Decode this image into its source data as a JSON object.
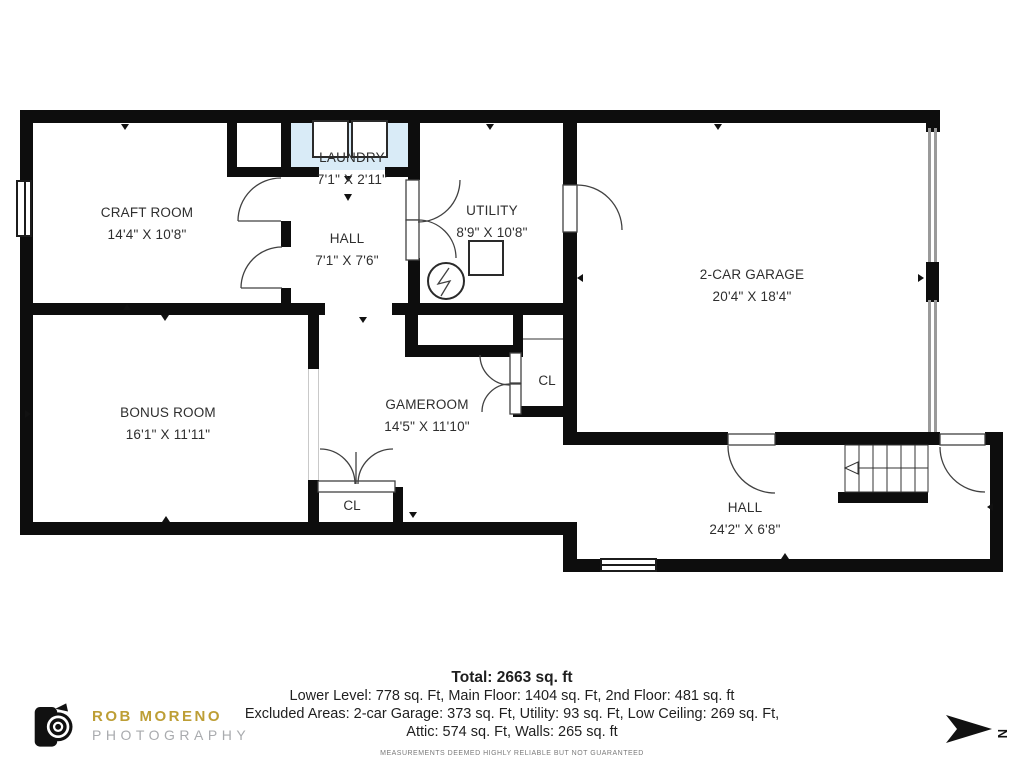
{
  "plan": {
    "rooms": {
      "craft_room": {
        "name": "CRAFT ROOM",
        "dims": "14'4\" X 10'8\""
      },
      "laundry": {
        "name": "LAUNDRY",
        "dims": "7'1\" X 2'11\""
      },
      "hall_upper": {
        "name": "HALL",
        "dims": "7'1\" X 7'6\""
      },
      "utility": {
        "name": "UTILITY",
        "dims": "8'9\" X 10'8\""
      },
      "garage": {
        "name": "2-CAR GARAGE",
        "dims": "20'4\" X 18'4\""
      },
      "bonus_room": {
        "name": "BONUS ROOM",
        "dims": "16'1\" X 11'11\""
      },
      "gameroom": {
        "name": "GAMEROOM",
        "dims": "14'5\" X 11'10\""
      },
      "hall_lower": {
        "name": "HALL",
        "dims": "24'2\" X 6'8\""
      }
    },
    "closets": {
      "gameroom_closet": "CL",
      "bonus_hall_closet": "CL"
    }
  },
  "summary": {
    "total": "Total: 2663 sq. ft",
    "line1": "Lower Level: 778 sq. Ft, Main Floor: 1404 sq. Ft, 2nd Floor: 481 sq. ft",
    "line2": "Excluded Areas: 2-car Garage: 373 sq. Ft, Utility: 93 sq. Ft, Low Ceiling: 269 sq. Ft,",
    "line3": "Attic: 574 sq. Ft, Walls: 265 sq. ft",
    "disclaimer": "MEASUREMENTS DEEMED HIGHLY RELIABLE BUT NOT GUARANTEED"
  },
  "branding": {
    "name": "ROB MORENO",
    "subtitle": "PHOTOGRAPHY"
  },
  "compass": {
    "north_label": "N"
  },
  "colors": {
    "wall": "#0d0d0d",
    "laundry_fill": "#D9EBF7",
    "logo_gold": "#BD9E35",
    "logo_gray": "#A9ABAE"
  }
}
